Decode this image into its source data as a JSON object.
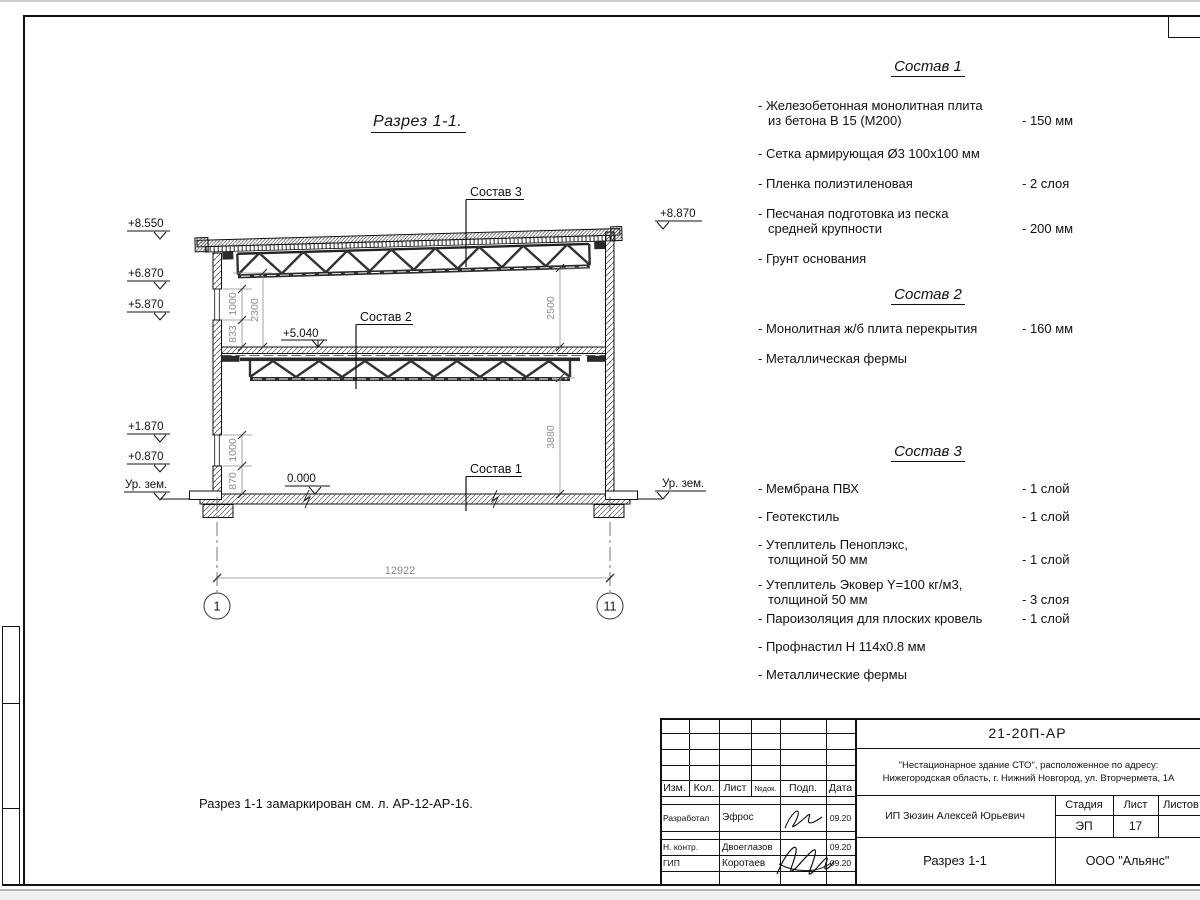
{
  "drawing": {
    "title": "Разрез 1-1.",
    "leaders": {
      "sostav1": "Состав 1",
      "sostav2": "Состав 2",
      "sostav3": "Состав 3"
    },
    "elevations_left": [
      {
        "label": "+8.550"
      },
      {
        "label": "+6.870"
      },
      {
        "label": "+5.870"
      },
      {
        "label": "+1.870"
      },
      {
        "label": "+0.870"
      },
      {
        "label": "Ур. зем."
      }
    ],
    "elevations_right": [
      {
        "label": "+8.870"
      },
      {
        "label": "Ур. зем."
      }
    ],
    "inner_elevations": [
      {
        "label": "+5.040"
      },
      {
        "label": "0.000"
      }
    ],
    "dimensions": {
      "span": "12922",
      "left_upper_1": "1000",
      "left_upper_2": "833",
      "left_upper_total": "2300",
      "left_lower_1": "1000",
      "left_lower_2": "870",
      "right_upper": "2500",
      "right_lower": "3880"
    },
    "axes": [
      "1",
      "11"
    ]
  },
  "specs": [
    {
      "title": "Состав 1",
      "items": [
        {
          "lines": [
            "- Железобетонная  монолитная плита",
            "из бетона В 15 (М200)"
          ],
          "value": "- 150 мм"
        },
        {
          "lines": [
            "- Сетка армирующая Ø3 100х100 мм"
          ],
          "value": ""
        },
        {
          "lines": [
            "- Пленка полиэтиленовая"
          ],
          "value": "-  2 слоя"
        },
        {
          "lines": [
            "- Песчаная подготовка из песка",
            "средней крупности"
          ],
          "value": "- 200 мм"
        },
        {
          "lines": [
            "- Грунт основания"
          ],
          "value": ""
        }
      ]
    },
    {
      "title": "Состав 2",
      "items": [
        {
          "lines": [
            "- Монолитная ж/б плита перекрытия"
          ],
          "value": "- 160 мм"
        },
        {
          "lines": [
            "- Металлическая фермы"
          ],
          "value": ""
        }
      ]
    },
    {
      "title": "Состав 3",
      "items": [
        {
          "lines": [
            "- Мембрана ПВХ"
          ],
          "value": "- 1 слой"
        },
        {
          "lines": [
            "- Геотекстиль"
          ],
          "value": "- 1 слой"
        },
        {
          "lines": [
            "- Утеплитель Пеноплэкс,",
            "толщиной 50 мм"
          ],
          "value": "- 1 слой"
        },
        {
          "lines": [
            "- Утеплитель Эковер Y=100 кг/м3,",
            "толщиной 50 мм"
          ],
          "value": "- 3 слоя"
        },
        {
          "lines": [
            "- Пароизоляция для плоских кровель"
          ],
          "value": "- 1 слой"
        },
        {
          "lines": [
            "- Профнастил Н 114х0.8 мм"
          ],
          "value": ""
        },
        {
          "lines": [
            "- Металлические фермы"
          ],
          "value": ""
        }
      ]
    }
  ],
  "note": "Разрез 1-1 замаркирован см. л. АР-12-АР-16.",
  "titleblock": {
    "doc_number": "21-20П-АР",
    "project_line1": "\"Нестационарное здание СТО\", расположенное по адресу:",
    "project_line2": "Нижегородская область, г. Нижний Новгород, ул. Вторчермета, 1А",
    "client": "ИП Зюзин Алексей Юрьевич",
    "sheet_title": "Разрез 1-1",
    "company": "ООО \"Альянс\"",
    "columns": {
      "izm": "Изм.",
      "kol": "Кол.",
      "list": "Лист",
      "ndok": "№док.",
      "podp": "Подп.",
      "data": "Дата"
    },
    "stage_label": "Стадия",
    "sheet_label": "Лист",
    "sheets_label": "Листов",
    "stage_value": "ЭП",
    "sheet_value": "17",
    "signature_rows": [
      {
        "role": "Разработал",
        "name": "Эфрос",
        "date": "09.20"
      },
      {
        "role": "Н. контр.",
        "name": "Двоеглазов",
        "date": "09.20"
      },
      {
        "role": "ГИП",
        "name": "Коротаев",
        "date": "09.20"
      }
    ]
  }
}
